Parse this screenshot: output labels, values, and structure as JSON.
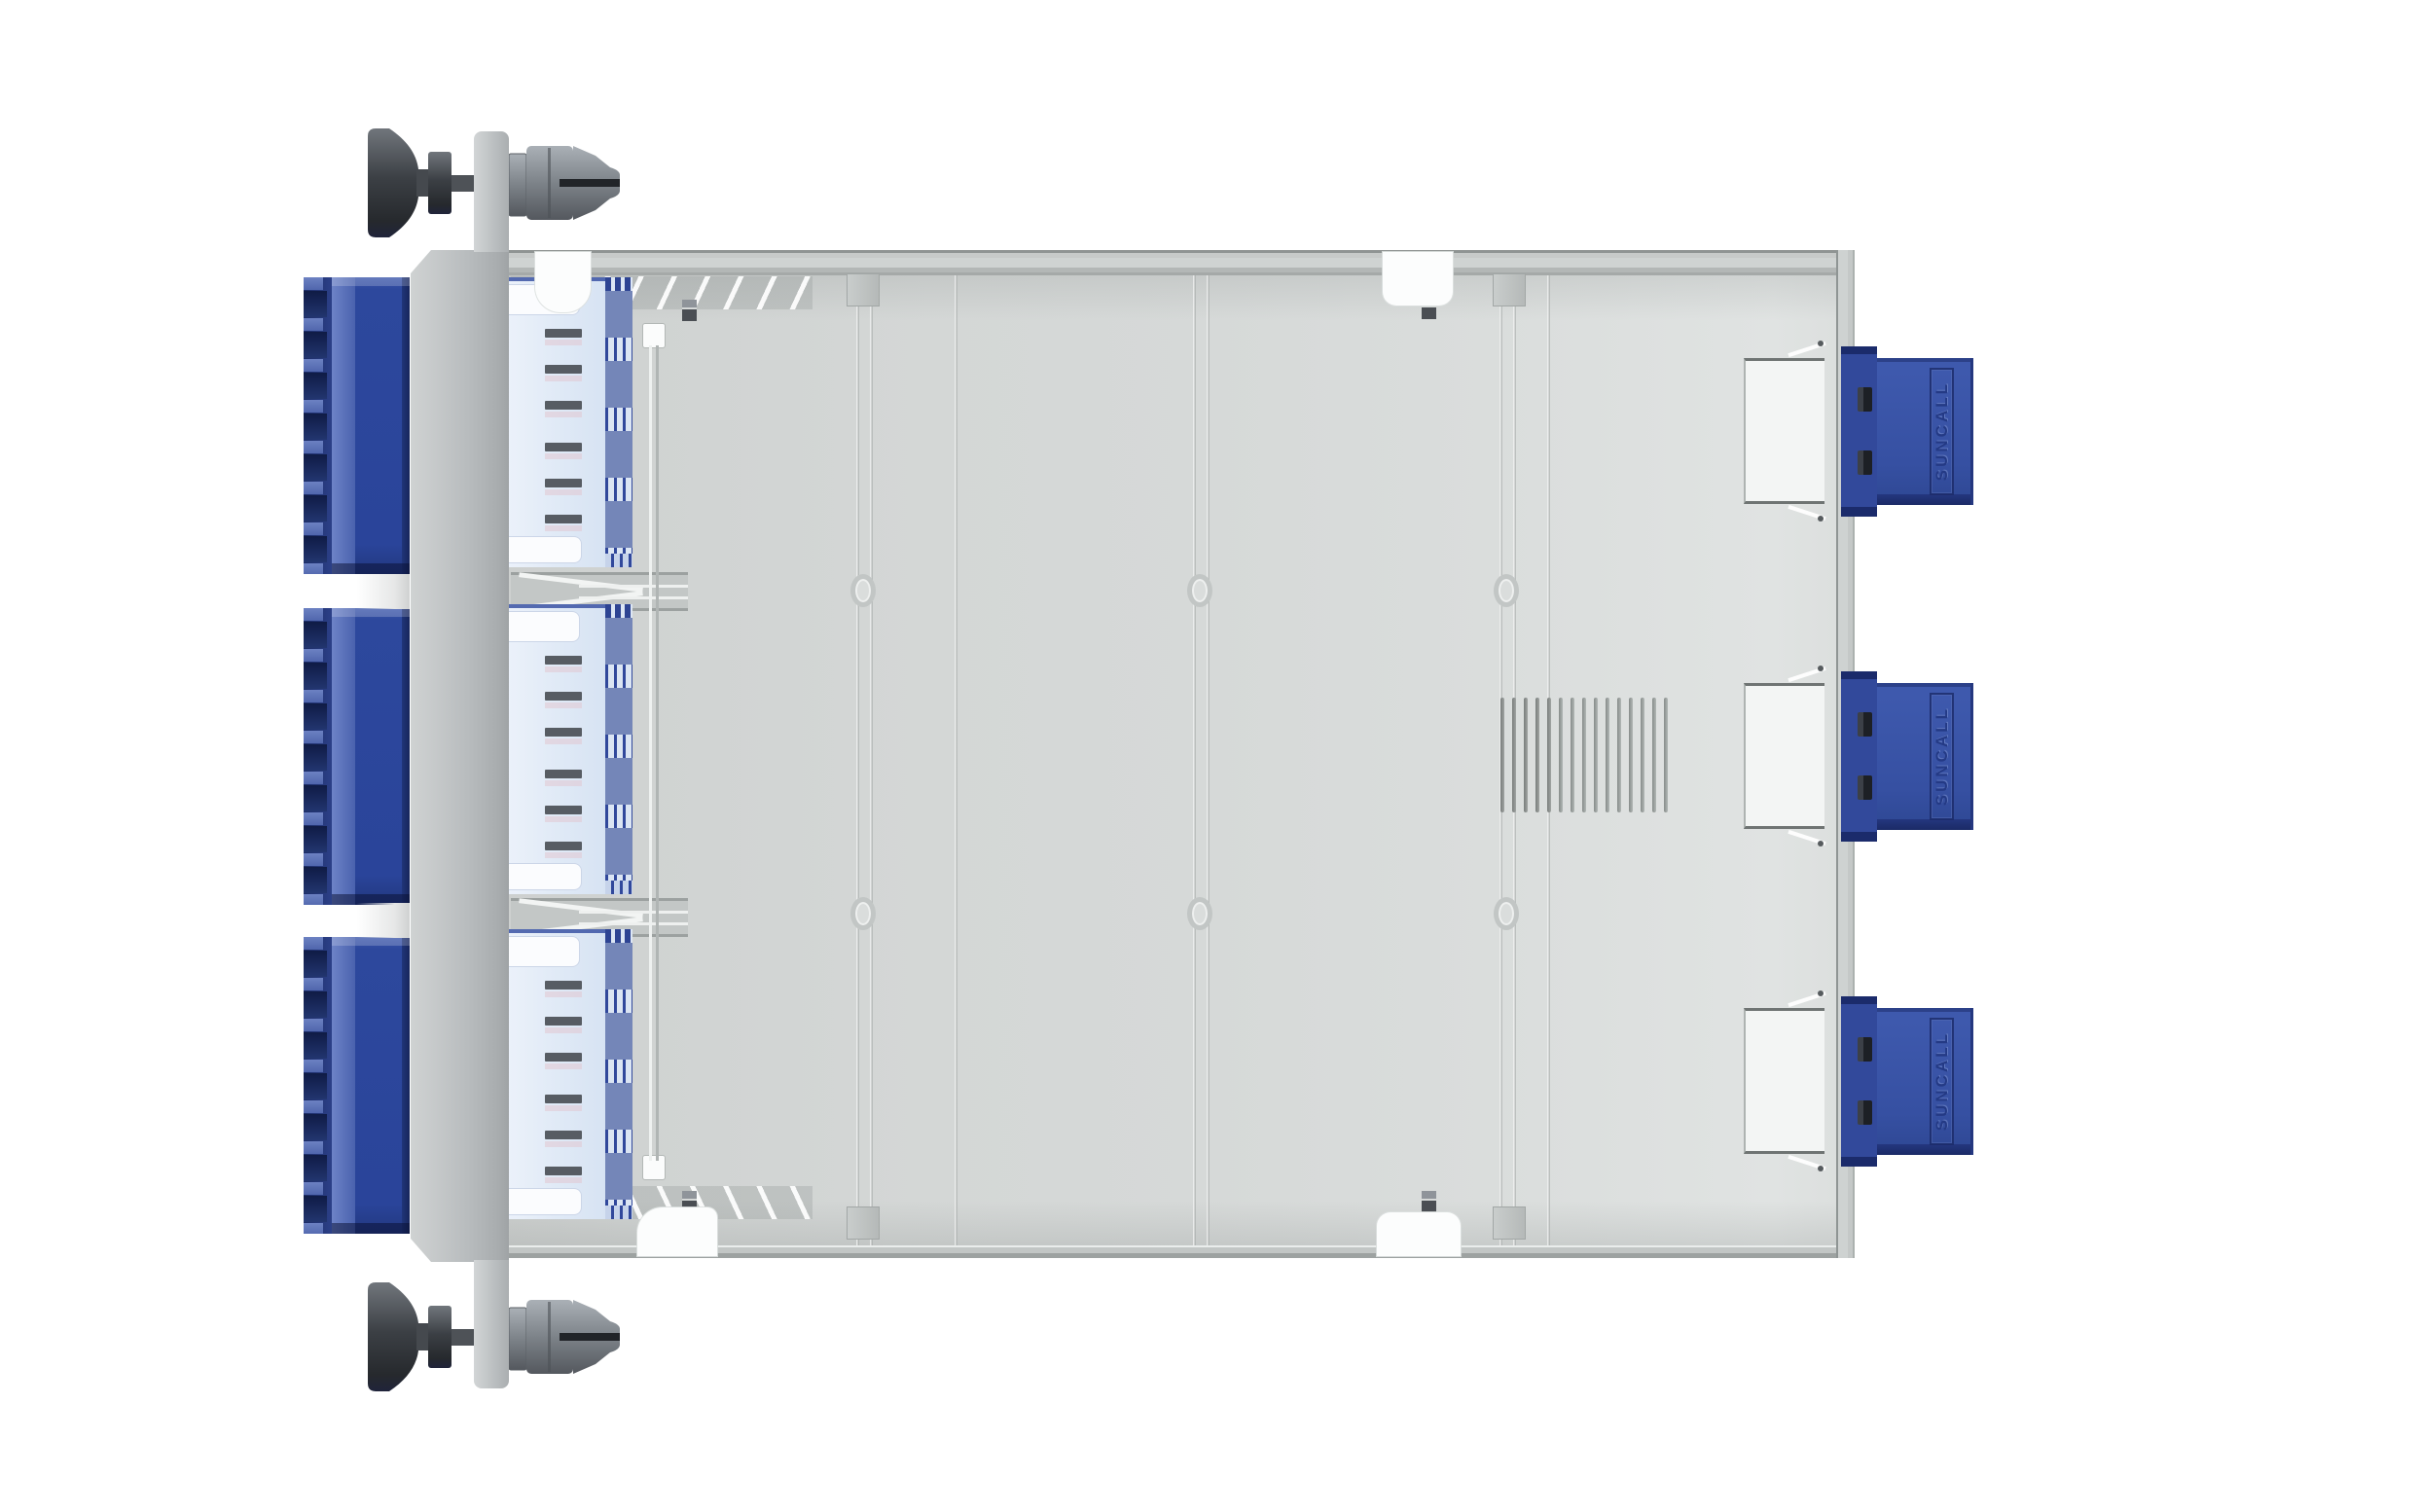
{
  "scene": {
    "background_color": "#ffffff",
    "object": "fiber optic cassette module, top view"
  },
  "brand": {
    "text": "SUNCALL"
  },
  "front_panel": {
    "thumbscrew_count": 2,
    "lc_banks": {
      "count": 3,
      "teeth_per_bank": 8,
      "slots_per_bank": 7,
      "body_color": "#2a449a",
      "dark_color": "#14214f",
      "light_color": "#5e74b8"
    }
  },
  "tray": {
    "floor_color": "#d4d7d6",
    "rim_color": "#c7cac9",
    "vents": {
      "count": 15
    },
    "rows": {
      "count": 3,
      "dashes_per_row": 6,
      "dash_offsets": [
        53,
        90,
        127,
        170,
        207,
        244
      ],
      "stripe_bands": 4,
      "panel_color": "#dfe9f6",
      "stripe_color": "#7486b8",
      "dash_color": "#575c63"
    },
    "ribs": {
      "vertical_x": [
        357,
        371,
        458,
        703,
        717,
        1018,
        1032,
        1067
      ],
      "horizontal_y": [
        340,
        675
      ],
      "bosses": [
        [
          364,
          350
        ],
        [
          710,
          350
        ],
        [
          1025,
          350
        ],
        [
          364,
          682
        ],
        [
          710,
          682
        ],
        [
          1025,
          682
        ]
      ]
    },
    "miniclips": [
      [
        178,
        51
      ],
      [
        178,
        967
      ],
      [
        938,
        49
      ],
      [
        938,
        967
      ]
    ],
    "rib_posts": [
      [
        347,
        24
      ],
      [
        347,
        983
      ],
      [
        1011,
        24
      ],
      [
        1011,
        983
      ]
    ],
    "wall_cutout_tops": [
      96,
      430,
      764
    ],
    "midguide_tops": [
      331,
      666
    ],
    "adapter_tops": [
      91,
      425,
      759
    ]
  },
  "rear_connectors": {
    "count": 3,
    "tops": [
      356,
      690,
      1024
    ],
    "body_color": "#3650a2",
    "slot_color": "#1d2025",
    "label_plate_color": "#f3f5f4"
  },
  "layout_tops": {
    "lc_bank_tops": [
      285,
      625,
      963
    ],
    "lc_gap_tops": [
      590,
      928
    ],
    "row_interior_tops": [
      28,
      364,
      698
    ],
    "lidsq_tops": [
      76,
      931
    ]
  }
}
